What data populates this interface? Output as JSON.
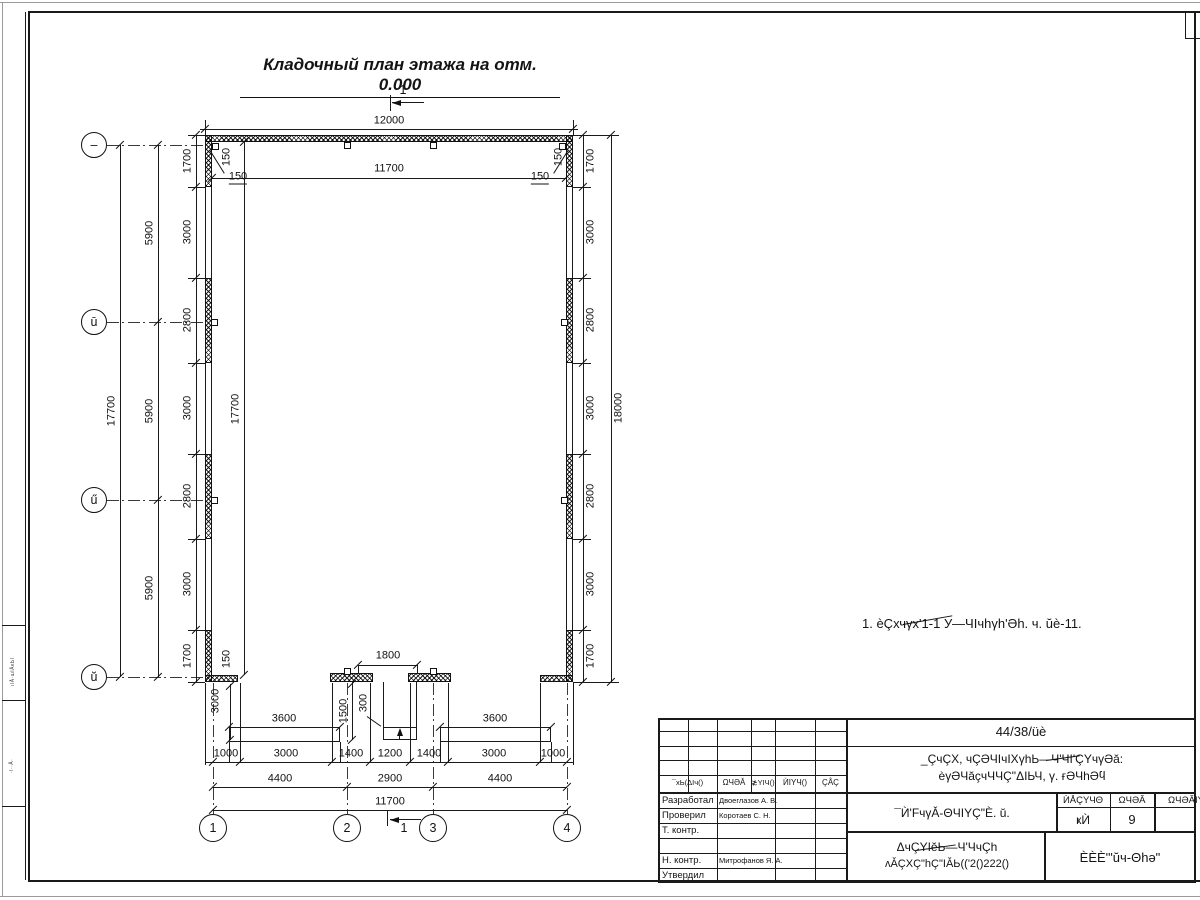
{
  "title": "Кладочный план этажа на отм. 0.000",
  "note": "1. èÇхчγх'1-1 У—ЧIчhγh'Əh. ч. ŭè-11.",
  "section_label": "1",
  "axes_left": [
    "–",
    "ū",
    "ű",
    "ŭ"
  ],
  "axes_bottom": [
    "1",
    "2",
    "3",
    "4"
  ],
  "dims": {
    "top_total": "12000",
    "inner_width": "11700",
    "inner_height": "17700",
    "left_total": "17700",
    "right_total": "18000",
    "bottom_total": "11700",
    "wall": "150",
    "left_chain": [
      "1700",
      "3000",
      "2800",
      "3000",
      "2800",
      "3000",
      "1700"
    ],
    "left_spans": [
      "5900",
      "5900",
      "5900"
    ],
    "right_chain": [
      "1700",
      "3000",
      "2800",
      "3000",
      "2800",
      "3000",
      "1700"
    ],
    "bottom_chain": [
      "1000",
      "3000",
      "1400",
      "1200",
      "1400",
      "3000",
      "1000"
    ],
    "bottom_spans": [
      "4400",
      "2900",
      "4400"
    ],
    "door": "1800",
    "porch": "3600",
    "porch_depth": "3000",
    "landing": "1500",
    "step": "300",
    "corner": "150"
  },
  "title_block": {
    "doc_code": "44/38/üè",
    "project_line1": "_ÇчÇХ, чÇƏЧIчIХγhЬ—Ч'ЧI'ÇΥчγƏă:",
    "project_line2": "èγƏЧăçчЧЧÇ\"ΔIЬЧ, γ. ғƏЧhƏϥ",
    "sheet_title": "¯Ѝ'FчγǍ-ΘЧIΥÇ\"È. ŭ.",
    "doc_type_line1": "ΔчÇΥIĕЬ—Ч'ЧчÇh",
    "doc_type_line2": "ʌǍÇХÇ\"hÇ\"IǍЬ(('2()222()",
    "organization": "ÈÈÈ'\"ŭч-Θhə\"",
    "rev_headers": [
      "¯хЬ(ΔIч()",
      "ΩЧƏĂ",
      "≵ΥIЧ()",
      "ЍIΥЧ()",
      "ÇÅÇ"
    ],
    "stage_headers": [
      "ЍÅÇΥЧΘ",
      "ΩЧƏĂ",
      "ΩЧƏĂIY"
    ],
    "stage_value": "ҝЍ",
    "sheet_number": "9",
    "roles": [
      "Разработал",
      "Проверил",
      "Т. контр.",
      "",
      "Н. контр.",
      "Утвердил"
    ],
    "names": [
      "Двоеглазов А. В.",
      "Коротаев С. Н.",
      "",
      "",
      "Митрофанов Я. А.",
      ""
    ]
  },
  "margin_labels": [
    "ıǀĂ·шІĂĸЬǀ",
    "·ǀ··Ă·"
  ]
}
